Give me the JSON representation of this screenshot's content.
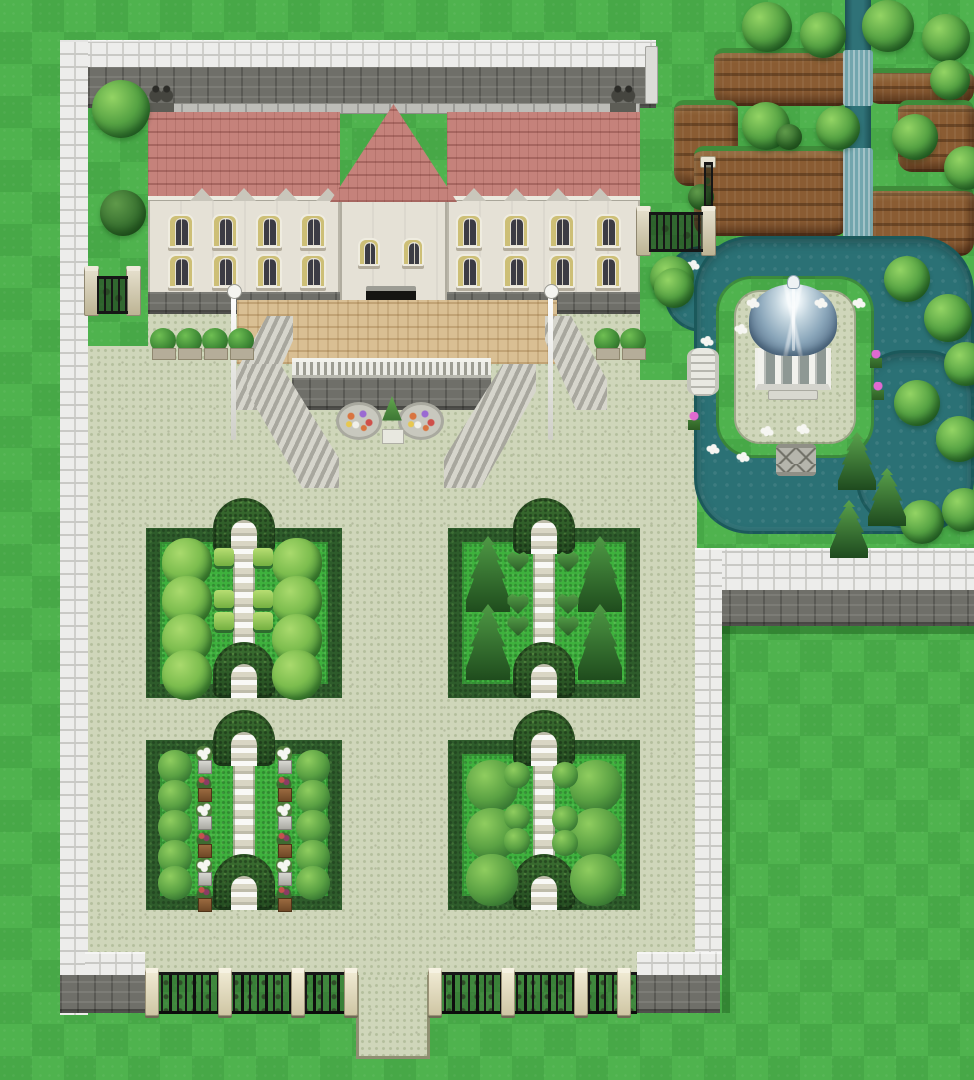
{
  "scene": {
    "label": "Top-down RPG tile map of a walled mansion estate with formal hedge gardens, a gazebo pond and terraced fields",
    "style": "16-bit RPG Maker style",
    "regions": [
      "mansion with red brick roof and shuttered windows",
      "front terrace with balustrade, twin staircases, flower beds and topiary",
      "pale cobblestone courtyard",
      "four hedge parterre garden plots with arched hedge gateways",
      "gazebo island surrounded by pond with two stone bridges",
      "terraced dirt fields with stream and waterfalls",
      "perimeter white stone wall with iron fences and gates",
      "open lawn"
    ]
  },
  "palette": {
    "grassA": "#4fb34e",
    "grassB": "#47a847",
    "pave": "#cfd6ba",
    "paveDot": "#b4bf9d",
    "tan": "#d9bf93",
    "roof": "#c5827b",
    "cream": "#e5e1d6",
    "stone": "#6f6f69",
    "whiteWall": "#ededeb",
    "hedge": "#2e5c2b",
    "gardenGrass": "#3eb13d",
    "water": "#2b7175",
    "dirt": "#8a5c33",
    "dome": "#8aa6ba",
    "iron": "#161616",
    "pillarBeige": "#d6cfae",
    "flowerWhite": "#f6f6f2",
    "flowerPink": "#e06ad0"
  },
  "objects": {
    "garden_plots": [
      {
        "x": 146,
        "y": 528,
        "w": 196,
        "h": 170
      },
      {
        "x": 448,
        "y": 528,
        "w": 192,
        "h": 170
      },
      {
        "x": 146,
        "y": 740,
        "w": 196,
        "h": 170
      },
      {
        "x": 448,
        "y": 740,
        "w": 192,
        "h": 170
      }
    ],
    "fluffy_bushes": [
      {
        "x": 162,
        "y": 538
      },
      {
        "x": 162,
        "y": 576
      },
      {
        "x": 162,
        "y": 614
      },
      {
        "x": 162,
        "y": 650
      },
      {
        "x": 272,
        "y": 538
      },
      {
        "x": 272,
        "y": 576
      },
      {
        "x": 272,
        "y": 614
      },
      {
        "x": 272,
        "y": 650
      }
    ],
    "square_bushes": [
      {
        "x": 214,
        "y": 548
      },
      {
        "x": 253,
        "y": 548
      },
      {
        "x": 214,
        "y": 590
      },
      {
        "x": 253,
        "y": 590
      },
      {
        "x": 214,
        "y": 612
      },
      {
        "x": 253,
        "y": 612
      }
    ],
    "conifer_trees": [
      {
        "x": 466,
        "y": 536
      },
      {
        "x": 466,
        "y": 604
      },
      {
        "x": 578,
        "y": 536
      },
      {
        "x": 578,
        "y": 604
      }
    ],
    "heart_bushes": [
      {
        "x": 506,
        "y": 550
      },
      {
        "x": 556,
        "y": 550
      },
      {
        "x": 506,
        "y": 592
      },
      {
        "x": 556,
        "y": 592
      },
      {
        "x": 506,
        "y": 614
      },
      {
        "x": 556,
        "y": 614
      }
    ],
    "round_bushes": [
      {
        "x": 158,
        "y": 750,
        "s": 34
      },
      {
        "x": 158,
        "y": 780,
        "s": 34
      },
      {
        "x": 158,
        "y": 810,
        "s": 34
      },
      {
        "x": 158,
        "y": 840,
        "s": 34
      },
      {
        "x": 158,
        "y": 866,
        "s": 34
      },
      {
        "x": 296,
        "y": 750,
        "s": 34
      },
      {
        "x": 296,
        "y": 780,
        "s": 34
      },
      {
        "x": 296,
        "y": 810,
        "s": 34
      },
      {
        "x": 296,
        "y": 840,
        "s": 34
      },
      {
        "x": 296,
        "y": 866,
        "s": 34
      },
      {
        "x": 466,
        "y": 760,
        "s": 52
      },
      {
        "x": 466,
        "y": 808,
        "s": 52
      },
      {
        "x": 466,
        "y": 854,
        "s": 52
      },
      {
        "x": 570,
        "y": 760,
        "s": 52
      },
      {
        "x": 570,
        "y": 808,
        "s": 52
      },
      {
        "x": 570,
        "y": 854,
        "s": 52
      },
      {
        "x": 504,
        "y": 762,
        "s": 26
      },
      {
        "x": 504,
        "y": 804,
        "s": 26
      },
      {
        "x": 504,
        "y": 828,
        "s": 26
      },
      {
        "x": 552,
        "y": 762,
        "s": 26
      },
      {
        "x": 552,
        "y": 806,
        "s": 26
      },
      {
        "x": 552,
        "y": 830,
        "s": 26
      }
    ],
    "pedestals": [
      {
        "x": 196,
        "y": 746,
        "kind": "flower"
      },
      {
        "x": 196,
        "y": 774,
        "kind": "planter"
      },
      {
        "x": 196,
        "y": 802,
        "kind": "flower"
      },
      {
        "x": 196,
        "y": 830,
        "kind": "planter"
      },
      {
        "x": 196,
        "y": 858,
        "kind": "flower"
      },
      {
        "x": 196,
        "y": 884,
        "kind": "planter"
      },
      {
        "x": 276,
        "y": 746,
        "kind": "flower"
      },
      {
        "x": 276,
        "y": 774,
        "kind": "planter"
      },
      {
        "x": 276,
        "y": 802,
        "kind": "flower"
      },
      {
        "x": 276,
        "y": 830,
        "kind": "planter"
      },
      {
        "x": 276,
        "y": 858,
        "kind": "flower"
      },
      {
        "x": 276,
        "y": 884,
        "kind": "planter"
      }
    ],
    "windows": [
      {
        "x": 168,
        "y": 214
      },
      {
        "x": 212,
        "y": 214
      },
      {
        "x": 256,
        "y": 214
      },
      {
        "x": 300,
        "y": 214
      },
      {
        "x": 456,
        "y": 214
      },
      {
        "x": 503,
        "y": 214
      },
      {
        "x": 549,
        "y": 214
      },
      {
        "x": 595,
        "y": 214
      },
      {
        "x": 168,
        "y": 254
      },
      {
        "x": 212,
        "y": 254
      },
      {
        "x": 256,
        "y": 254
      },
      {
        "x": 300,
        "y": 254
      },
      {
        "x": 456,
        "y": 254
      },
      {
        "x": 503,
        "y": 254
      },
      {
        "x": 549,
        "y": 254
      },
      {
        "x": 595,
        "y": 254
      },
      {
        "x": 358,
        "y": 238,
        "kind": "small"
      },
      {
        "x": 402,
        "y": 238,
        "kind": "small"
      }
    ],
    "dormers": [
      {
        "x": 190
      },
      {
        "x": 232
      },
      {
        "x": 274
      },
      {
        "x": 316
      },
      {
        "x": 462
      },
      {
        "x": 504
      },
      {
        "x": 546
      },
      {
        "x": 588
      }
    ],
    "statues": [
      {
        "x": 148,
        "y": 84
      },
      {
        "x": 610,
        "y": 84
      }
    ],
    "lamp_posts": [
      {
        "x": 231,
        "y": 294
      },
      {
        "x": 548,
        "y": 294
      }
    ],
    "planter_bushes": [
      {
        "x": 150,
        "y": 328
      },
      {
        "x": 176,
        "y": 328
      },
      {
        "x": 202,
        "y": 328
      },
      {
        "x": 228,
        "y": 328
      },
      {
        "x": 594,
        "y": 328
      },
      {
        "x": 620,
        "y": 328
      }
    ],
    "flower_beds": [
      {
        "x": 336,
        "y": 402
      },
      {
        "x": 398,
        "y": 402
      }
    ],
    "trees": [
      {
        "x": 92,
        "y": 80,
        "s": 58
      },
      {
        "x": 100,
        "y": 190,
        "s": 46,
        "kind": "dark"
      },
      {
        "x": 650,
        "y": 256,
        "s": 44
      },
      {
        "x": 742,
        "y": 2,
        "s": 50
      },
      {
        "x": 800,
        "y": 12,
        "s": 46
      },
      {
        "x": 862,
        "y": 0,
        "s": 52
      },
      {
        "x": 922,
        "y": 14,
        "s": 48
      },
      {
        "x": 930,
        "y": 60,
        "s": 40
      },
      {
        "x": 742,
        "y": 102,
        "s": 48
      },
      {
        "x": 816,
        "y": 106,
        "s": 44
      },
      {
        "x": 892,
        "y": 114,
        "s": 46
      },
      {
        "x": 944,
        "y": 146,
        "s": 44
      },
      {
        "x": 776,
        "y": 124,
        "s": 26,
        "kind": "dark"
      },
      {
        "x": 688,
        "y": 184,
        "s": 26,
        "kind": "dark"
      },
      {
        "x": 654,
        "y": 268,
        "s": 40
      },
      {
        "x": 884,
        "y": 256,
        "s": 46
      },
      {
        "x": 924,
        "y": 294,
        "s": 48
      },
      {
        "x": 944,
        "y": 342,
        "s": 44
      },
      {
        "x": 894,
        "y": 380,
        "s": 46
      },
      {
        "x": 936,
        "y": 416,
        "s": 46
      },
      {
        "x": 900,
        "y": 500,
        "s": 44
      },
      {
        "x": 942,
        "y": 488,
        "s": 44
      }
    ],
    "pines": [
      {
        "x": 838,
        "y": 432
      },
      {
        "x": 868,
        "y": 468
      },
      {
        "x": 830,
        "y": 500
      }
    ],
    "cliffs": [
      {
        "x": 714,
        "y": 48,
        "w": 138,
        "h": 58
      },
      {
        "x": 866,
        "y": 68,
        "w": 108,
        "h": 36
      },
      {
        "x": 898,
        "y": 100,
        "w": 76,
        "h": 72
      },
      {
        "x": 674,
        "y": 100,
        "w": 64,
        "h": 86
      },
      {
        "x": 694,
        "y": 146,
        "w": 154,
        "h": 90
      },
      {
        "x": 866,
        "y": 186,
        "w": 108,
        "h": 70
      }
    ],
    "water_pools": [
      {
        "x": 664,
        "y": 246,
        "w": 118,
        "h": 86,
        "r": "38px"
      },
      {
        "x": 694,
        "y": 236,
        "w": 280,
        "h": 298,
        "r": "56px"
      },
      {
        "x": 856,
        "y": 350,
        "w": 118,
        "h": 178,
        "r": "48px"
      }
    ],
    "waterfalls": [
      {
        "x": 843,
        "y": 50,
        "w": 30,
        "h": 56
      },
      {
        "x": 843,
        "y": 148,
        "w": 30,
        "h": 90
      }
    ],
    "fences": [
      {
        "x": 145,
        "w": 213
      },
      {
        "x": 428,
        "w": 209
      }
    ],
    "fence_pillars": [
      {
        "x": 145
      },
      {
        "x": 218
      },
      {
        "x": 291
      },
      {
        "x": 344
      },
      {
        "x": 428
      },
      {
        "x": 501
      },
      {
        "x": 574
      },
      {
        "x": 617
      }
    ],
    "flowers": [
      {
        "x": 746,
        "y": 298,
        "kind": "white"
      },
      {
        "x": 734,
        "y": 324,
        "kind": "white"
      },
      {
        "x": 700,
        "y": 336,
        "kind": "white"
      },
      {
        "x": 814,
        "y": 298,
        "kind": "white"
      },
      {
        "x": 760,
        "y": 426,
        "kind": "white"
      },
      {
        "x": 796,
        "y": 424,
        "kind": "white"
      },
      {
        "x": 706,
        "y": 444,
        "kind": "white"
      },
      {
        "x": 736,
        "y": 452,
        "kind": "white"
      },
      {
        "x": 852,
        "y": 298,
        "kind": "white"
      },
      {
        "x": 686,
        "y": 260,
        "kind": "white"
      },
      {
        "x": 870,
        "y": 350,
        "kind": "pink"
      },
      {
        "x": 872,
        "y": 382,
        "kind": "pink"
      },
      {
        "x": 688,
        "y": 412,
        "kind": "pink"
      }
    ]
  }
}
